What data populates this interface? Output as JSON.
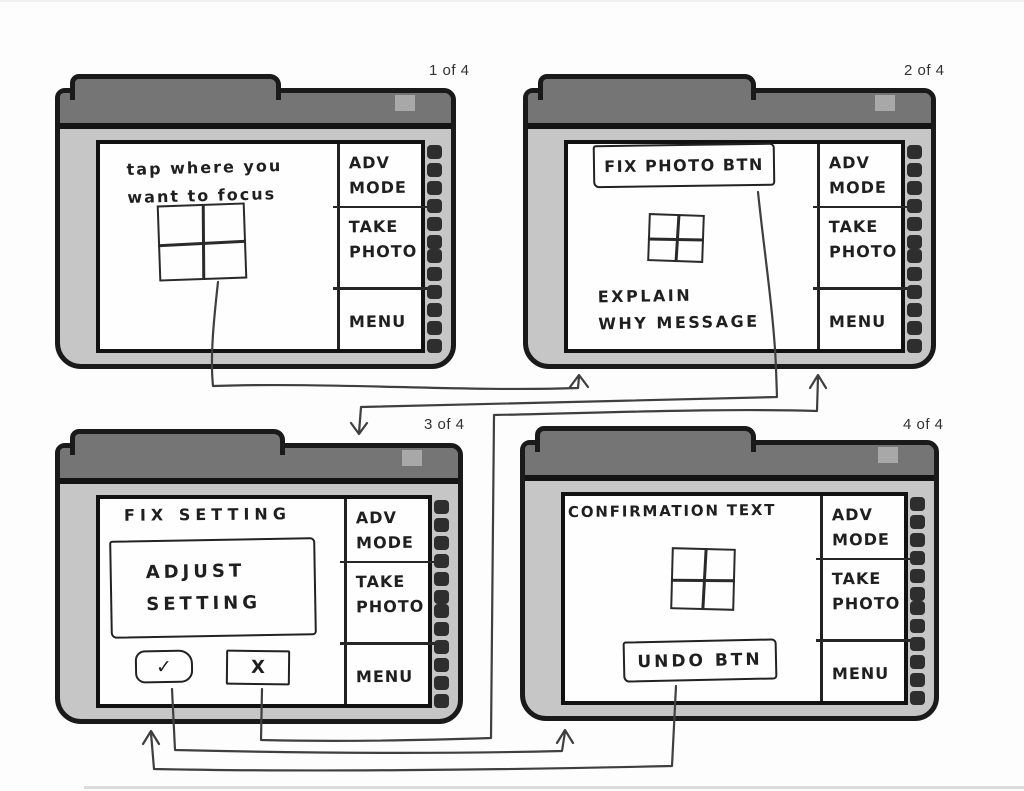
{
  "screens": {
    "s1": {
      "page_label": "1 of 4",
      "note_line1": "tap where you",
      "note_line2": "want to focus"
    },
    "s2": {
      "page_label": "2 of 4",
      "fix_photo_button": "FIX PHOTO BTN",
      "note_line1": "EXPLAIN",
      "note_line2": "WHY MESSAGE"
    },
    "s3": {
      "page_label": "3 of 4",
      "heading": "FIX SETTING",
      "dialog_line1": "ADJUST",
      "dialog_line2": "SETTING",
      "confirm_glyph": "✓",
      "cancel_glyph": "X"
    },
    "s4": {
      "page_label": "4 of 4",
      "heading": "CONFIRMATION TEXT",
      "undo_button": "UNDO BTN"
    }
  },
  "sidebar": {
    "adv_line1": "ADV",
    "adv_line2": "MODE",
    "take_line1": "TAKE",
    "take_line2": "PHOTO",
    "menu": "MENU"
  },
  "icons": {
    "focus_grid": "focus-grid",
    "check": "✓",
    "cancel": "X"
  },
  "colors": {
    "device_frame": "#c6c6c6",
    "top_bar": "#757575",
    "screen": "#fefefe",
    "ink": "#1f1f1f",
    "connector": "#3f3f3f",
    "button_dots": "#2e2e2e",
    "bar_slot": "#a8a8a8"
  }
}
